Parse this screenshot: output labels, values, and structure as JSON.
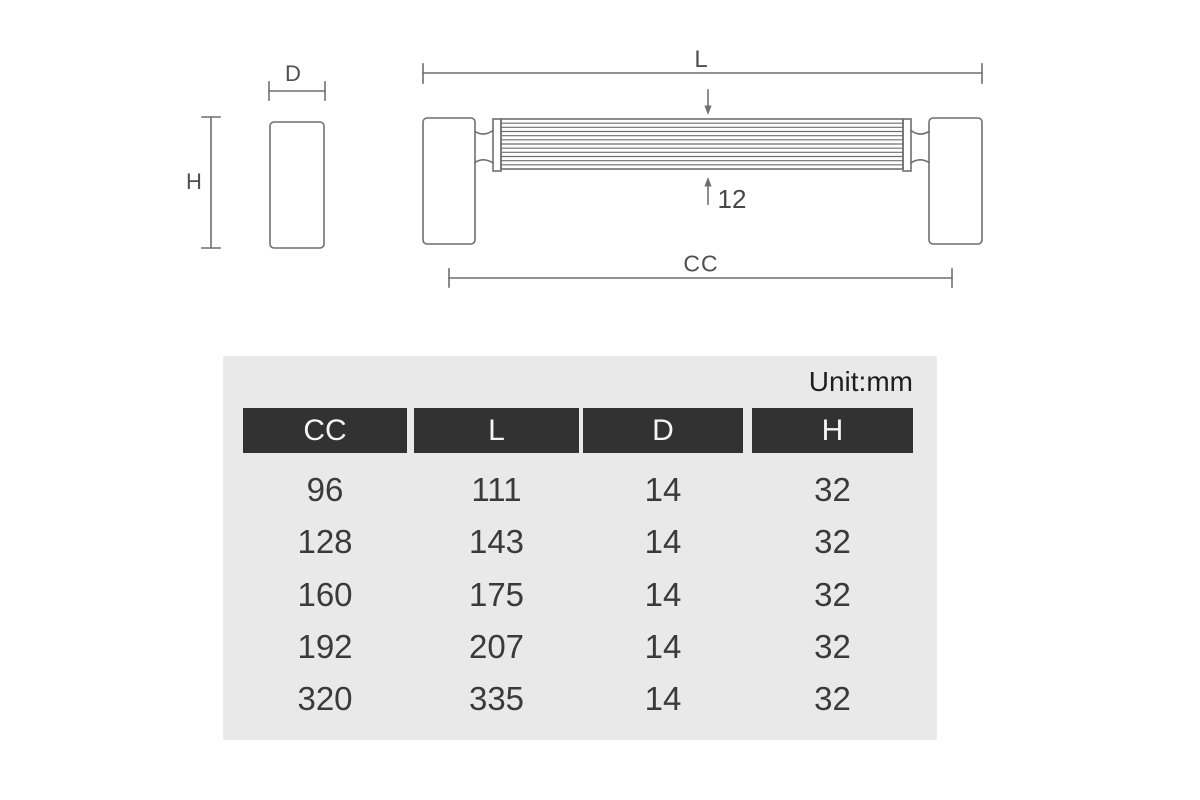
{
  "drawing": {
    "side_view": {
      "width_label": "D",
      "height_label": "H"
    },
    "front_view": {
      "length_label": "L",
      "bar_diameter_label": "12",
      "center_to_center_label": "CC"
    }
  },
  "table": {
    "unit_label": "Unit:mm",
    "columns": [
      "CC",
      "L",
      "D",
      "H"
    ],
    "rows": [
      [
        "96",
        "111",
        "14",
        "32"
      ],
      [
        "128",
        "143",
        "14",
        "32"
      ],
      [
        "160",
        "175",
        "14",
        "32"
      ],
      [
        "192",
        "207",
        "14",
        "32"
      ],
      [
        "320",
        "335",
        "14",
        "32"
      ]
    ]
  },
  "colors": {
    "page_bg": "#ffffff",
    "panel_bg": "#e9e9e9",
    "header_bg": "#323232",
    "header_text": "#f5f5f5",
    "value_text": "#3a3a3a",
    "unit_text": "#1e1e1e",
    "drawing_line": "#6f6f6f",
    "dim_label_text": "#4f4f4f"
  }
}
